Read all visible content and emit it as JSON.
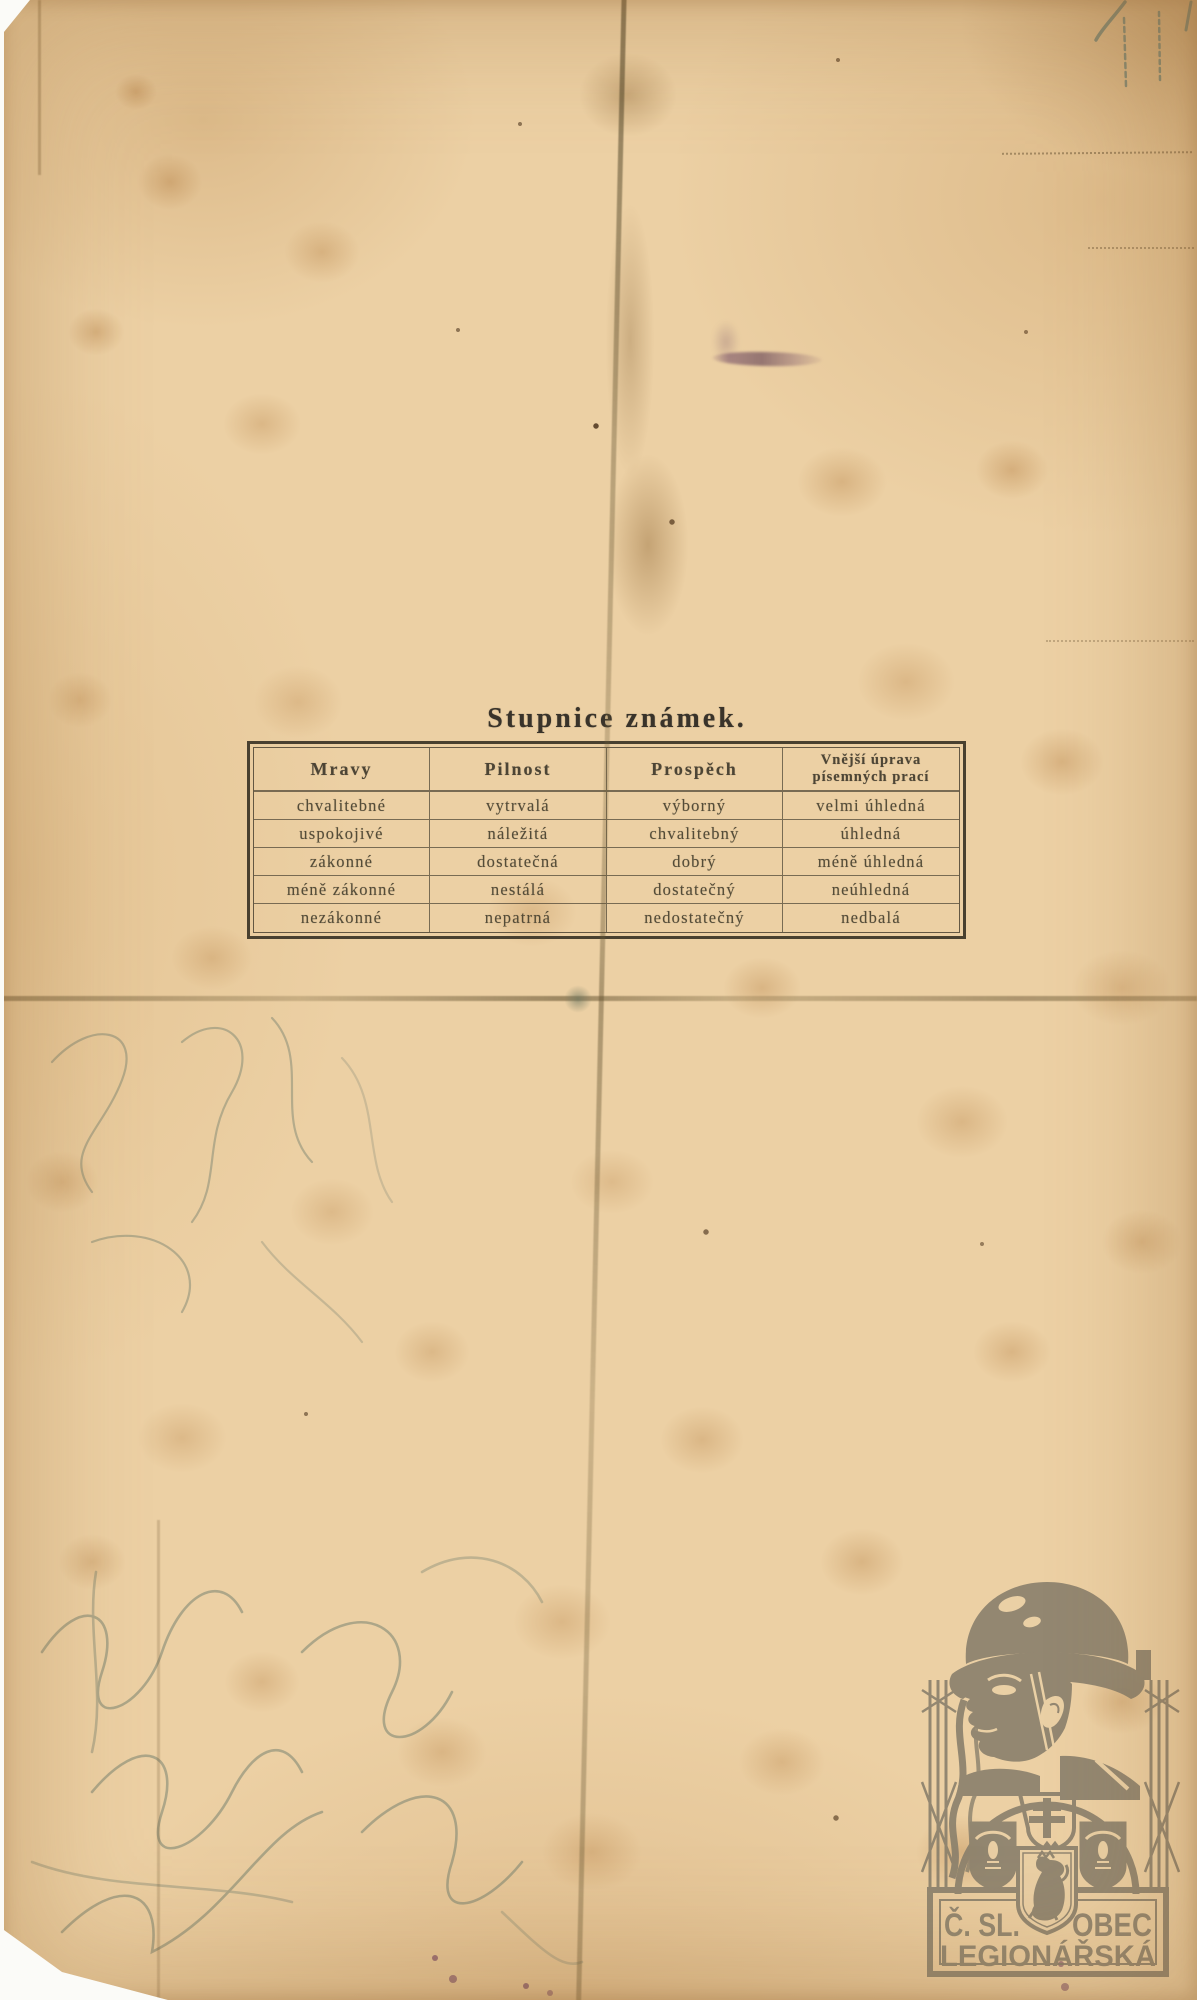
{
  "page": {
    "title": "Stupnice známek.",
    "grading_table": {
      "headers": [
        "Mravy",
        "Pilnost",
        "Prospěch",
        "Vnější úprava písemných prací"
      ],
      "rows": [
        [
          "chvalitebné",
          "vytrvalá",
          "výborný",
          "velmi úhledná"
        ],
        [
          "uspokojivé",
          "náležitá",
          "chvalitebný",
          "úhledná"
        ],
        [
          "zákonné",
          "dostatečná",
          "dobrý",
          "méně úhledná"
        ],
        [
          "méně zákonné",
          "nestálá",
          "dostatečný",
          "neúhledná"
        ],
        [
          "nezákonné",
          "nepatrná",
          "nedostatečný",
          "nedbalá"
        ]
      ]
    },
    "stamp": {
      "org_abbrev": "Č. SL.",
      "org_word": "OBEC",
      "org_name_line2": "LEGIONÁŘSKÁ",
      "color": "#877e6b"
    },
    "colors": {
      "paper": "#ecd0a4",
      "ink": "#3e382b",
      "stain": "#c0905c",
      "pencil": "#74806f",
      "purple_smudge": "#6d4562",
      "scan_background": "#fbfbf8"
    }
  }
}
